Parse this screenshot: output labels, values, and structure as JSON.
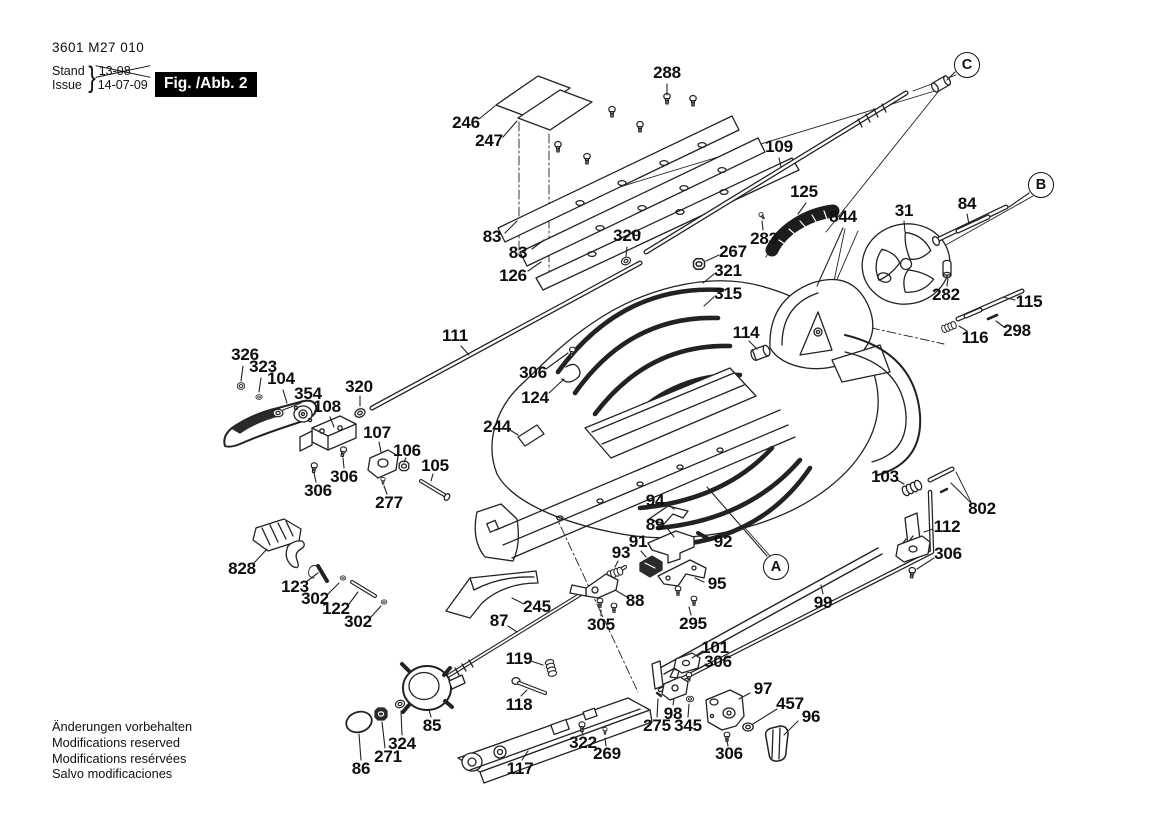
{
  "meta": {
    "part_number": "3601 M27 010",
    "stand_label": "Stand",
    "issue_label": "Issue",
    "brace": "}",
    "old_date": "13-08",
    "new_date": "14-07-09",
    "figure_label": "Fig. /Abb. 2"
  },
  "footer": {
    "lines": [
      "Änderungen vorbehalten",
      "Modifications reserved",
      "Modifications resérvées",
      "Salvo modificaciones"
    ]
  },
  "colors": {
    "ink": "#1a1a1a",
    "background": "#ffffff",
    "badge_bg": "#000000",
    "badge_text": "#ffffff"
  },
  "view_refs": [
    {
      "label": "A",
      "x": 776,
      "y": 567,
      "leader": [
        767,
        556,
        707,
        487
      ]
    },
    {
      "label": "B",
      "x": 1041,
      "y": 185,
      "leader": [
        1029,
        193,
        1009,
        207
      ]
    },
    {
      "label": "C",
      "x": 967,
      "y": 65,
      "leader": [
        955,
        72,
        947,
        80
      ]
    }
  ],
  "callouts": [
    {
      "num": "288",
      "x": 667,
      "y": 73,
      "leader": [
        667,
        84,
        667,
        95
      ]
    },
    {
      "num": "246",
      "x": 466,
      "y": 123,
      "leader": [
        479,
        119,
        495,
        106
      ]
    },
    {
      "num": "247",
      "x": 489,
      "y": 141,
      "leader": [
        503,
        137,
        517,
        121
      ]
    },
    {
      "num": "83",
      "x": 492,
      "y": 237,
      "leader": [
        505,
        233,
        517,
        221
      ]
    },
    {
      "num": "83",
      "x": 518,
      "y": 253,
      "leader": [
        532,
        249,
        544,
        240
      ]
    },
    {
      "num": "126",
      "x": 513,
      "y": 276,
      "leader": [
        528,
        271,
        541,
        262
      ]
    },
    {
      "num": "320",
      "x": 627,
      "y": 236,
      "leader": [
        627,
        247,
        626,
        256
      ]
    },
    {
      "num": "109",
      "x": 779,
      "y": 147,
      "leader": [
        779,
        158,
        781,
        167
      ]
    },
    {
      "num": "125",
      "x": 804,
      "y": 192,
      "leader": [
        806,
        203,
        798,
        214
      ]
    },
    {
      "num": "844",
      "x": 843,
      "y": 217,
      "leader": [
        843,
        228,
        817,
        286
      ]
    },
    {
      "num": "283",
      "x": 764,
      "y": 239,
      "leader": [
        763,
        230,
        762,
        221
      ]
    },
    {
      "num": "31",
      "x": 904,
      "y": 211,
      "leader": [
        904,
        221,
        905,
        232
      ]
    },
    {
      "num": "84",
      "x": 967,
      "y": 204,
      "leader": [
        967,
        214,
        969,
        224
      ]
    },
    {
      "num": "267",
      "x": 733,
      "y": 252,
      "leader": [
        719,
        255,
        706,
        261
      ]
    },
    {
      "num": "321",
      "x": 728,
      "y": 271,
      "leader": [
        714,
        274,
        703,
        283
      ]
    },
    {
      "num": "315",
      "x": 728,
      "y": 294,
      "leader": [
        714,
        297,
        704,
        306
      ]
    },
    {
      "num": "282",
      "x": 946,
      "y": 295,
      "leader": [
        947,
        286,
        948,
        278
      ]
    },
    {
      "num": "115",
      "x": 1029,
      "y": 302,
      "leader": [
        1015,
        300,
        1003,
        297
      ]
    },
    {
      "num": "116",
      "x": 975,
      "y": 338,
      "leader": [
        967,
        331,
        959,
        326
      ]
    },
    {
      "num": "298",
      "x": 1017,
      "y": 331,
      "leader": [
        1004,
        327,
        996,
        321
      ]
    },
    {
      "num": "114",
      "x": 746,
      "y": 333,
      "leader": [
        749,
        341,
        757,
        349
      ]
    },
    {
      "num": "306",
      "x": 533,
      "y": 373,
      "leader": [
        546,
        369,
        568,
        353
      ]
    },
    {
      "num": "124",
      "x": 535,
      "y": 398,
      "leader": [
        549,
        393,
        564,
        379
      ]
    },
    {
      "num": "111",
      "x": 455,
      "y": 336,
      "leader": [
        461,
        346,
        469,
        355
      ]
    },
    {
      "num": "326",
      "x": 245,
      "y": 355,
      "leader": [
        243,
        366,
        241,
        381
      ]
    },
    {
      "num": "323",
      "x": 263,
      "y": 367,
      "leader": [
        261,
        378,
        259,
        392
      ]
    },
    {
      "num": "104",
      "x": 281,
      "y": 379,
      "leader": [
        283,
        390,
        287,
        403
      ]
    },
    {
      "num": "354",
      "x": 308,
      "y": 394,
      "leader": [
        301,
        403,
        283,
        410
      ]
    },
    {
      "num": "108",
      "x": 327,
      "y": 407,
      "leader": [
        330,
        417,
        334,
        427
      ]
    },
    {
      "num": "320",
      "x": 359,
      "y": 387,
      "leader": [
        360,
        396,
        360,
        406
      ]
    },
    {
      "num": "107",
      "x": 377,
      "y": 433,
      "leader": [
        379,
        442,
        381,
        452
      ]
    },
    {
      "num": "106",
      "x": 407,
      "y": 451,
      "leader": [
        406,
        458,
        404,
        462
      ]
    },
    {
      "num": "105",
      "x": 435,
      "y": 466,
      "leader": [
        433,
        474,
        431,
        481
      ]
    },
    {
      "num": "306",
      "x": 344,
      "y": 477,
      "leader": [
        344,
        468,
        343,
        458
      ]
    },
    {
      "num": "306",
      "x": 318,
      "y": 491,
      "leader": [
        316,
        482,
        314,
        473
      ]
    },
    {
      "num": "277",
      "x": 389,
      "y": 503,
      "leader": [
        387,
        494,
        384,
        486
      ]
    },
    {
      "num": "244",
      "x": 497,
      "y": 427,
      "leader": [
        510,
        430,
        518,
        435
      ]
    },
    {
      "num": "94",
      "x": 655,
      "y": 501,
      "leader": [
        667,
        504,
        674,
        509
      ]
    },
    {
      "num": "89",
      "x": 655,
      "y": 525,
      "leader": [
        667,
        528,
        674,
        537
      ]
    },
    {
      "num": "92",
      "x": 723,
      "y": 542,
      "leader": [
        712,
        540,
        705,
        537
      ]
    },
    {
      "num": "91",
      "x": 638,
      "y": 542,
      "leader": [
        641,
        551,
        646,
        557
      ]
    },
    {
      "num": "93",
      "x": 621,
      "y": 553,
      "leader": [
        618,
        561,
        615,
        567
      ]
    },
    {
      "num": "95",
      "x": 717,
      "y": 584,
      "leader": [
        704,
        582,
        695,
        578
      ]
    },
    {
      "num": "88",
      "x": 635,
      "y": 601,
      "leader": [
        627,
        597,
        615,
        590
      ]
    },
    {
      "num": "305",
      "x": 601,
      "y": 625,
      "leader": [
        601,
        616,
        601,
        610
      ]
    },
    {
      "num": "295",
      "x": 693,
      "y": 624,
      "leader": [
        691,
        615,
        689,
        607
      ]
    },
    {
      "num": "99",
      "x": 823,
      "y": 603,
      "leader": [
        823,
        594,
        821,
        585
      ]
    },
    {
      "num": "103",
      "x": 885,
      "y": 477,
      "leader": [
        897,
        480,
        904,
        484
      ]
    },
    {
      "num": "802",
      "x": 982,
      "y": 509,
      "leader": [
        971,
        503,
        951,
        483
      ]
    },
    {
      "num": "112",
      "x": 947,
      "y": 527,
      "leader": [
        933,
        529,
        924,
        532
      ]
    },
    {
      "num": "306",
      "x": 948,
      "y": 554,
      "leader": [
        934,
        558,
        917,
        569
      ]
    },
    {
      "num": "828",
      "x": 242,
      "y": 569,
      "leader": [
        254,
        563,
        267,
        549
      ]
    },
    {
      "num": "123",
      "x": 295,
      "y": 587,
      "leader": [
        306,
        582,
        318,
        573
      ]
    },
    {
      "num": "302",
      "x": 315,
      "y": 599,
      "leader": [
        328,
        594,
        339,
        583
      ]
    },
    {
      "num": "122",
      "x": 336,
      "y": 609,
      "leader": [
        349,
        604,
        358,
        592
      ]
    },
    {
      "num": "302",
      "x": 358,
      "y": 622,
      "leader": [
        371,
        617,
        381,
        606
      ]
    },
    {
      "num": "87",
      "x": 499,
      "y": 621,
      "leader": [
        508,
        626,
        517,
        632
      ]
    },
    {
      "num": "245",
      "x": 537,
      "y": 607,
      "leader": [
        524,
        604,
        512,
        598
      ]
    },
    {
      "num": "119",
      "x": 519,
      "y": 659,
      "leader": [
        531,
        661,
        543,
        665
      ]
    },
    {
      "num": "118",
      "x": 519,
      "y": 705,
      "leader": [
        521,
        696,
        527,
        690
      ]
    },
    {
      "num": "85",
      "x": 432,
      "y": 726,
      "leader": [
        431,
        717,
        429,
        710
      ]
    },
    {
      "num": "324",
      "x": 402,
      "y": 744,
      "leader": [
        402,
        735,
        401,
        711
      ]
    },
    {
      "num": "271",
      "x": 388,
      "y": 757,
      "leader": [
        385,
        748,
        382,
        722
      ]
    },
    {
      "num": "86",
      "x": 361,
      "y": 769,
      "leader": [
        361,
        760,
        359,
        734
      ]
    },
    {
      "num": "117",
      "x": 520,
      "y": 769,
      "leader": [
        522,
        760,
        528,
        751
      ]
    },
    {
      "num": "322",
      "x": 583,
      "y": 743,
      "leader": [
        583,
        735,
        582,
        732
      ]
    },
    {
      "num": "269",
      "x": 607,
      "y": 754,
      "leader": [
        606,
        746,
        605,
        738
      ]
    },
    {
      "num": "101",
      "x": 715,
      "y": 648,
      "leader": [
        703,
        651,
        692,
        658
      ]
    },
    {
      "num": "306",
      "x": 718,
      "y": 662,
      "leader": [
        705,
        665,
        694,
        671
      ]
    },
    {
      "num": "98",
      "x": 673,
      "y": 714,
      "leader": [
        673,
        705,
        674,
        699
      ]
    },
    {
      "num": "275",
      "x": 657,
      "y": 726,
      "leader": [
        657,
        717,
        658,
        699
      ]
    },
    {
      "num": "345",
      "x": 688,
      "y": 726,
      "leader": [
        688,
        717,
        689,
        704
      ]
    },
    {
      "num": "97",
      "x": 763,
      "y": 689,
      "leader": [
        750,
        693,
        739,
        699
      ]
    },
    {
      "num": "457",
      "x": 790,
      "y": 704,
      "leader": [
        777,
        709,
        753,
        724
      ]
    },
    {
      "num": "96",
      "x": 811,
      "y": 717,
      "leader": [
        798,
        721,
        784,
        735
      ]
    },
    {
      "num": "306",
      "x": 729,
      "y": 754,
      "leader": [
        728,
        746,
        727,
        741
      ]
    }
  ]
}
